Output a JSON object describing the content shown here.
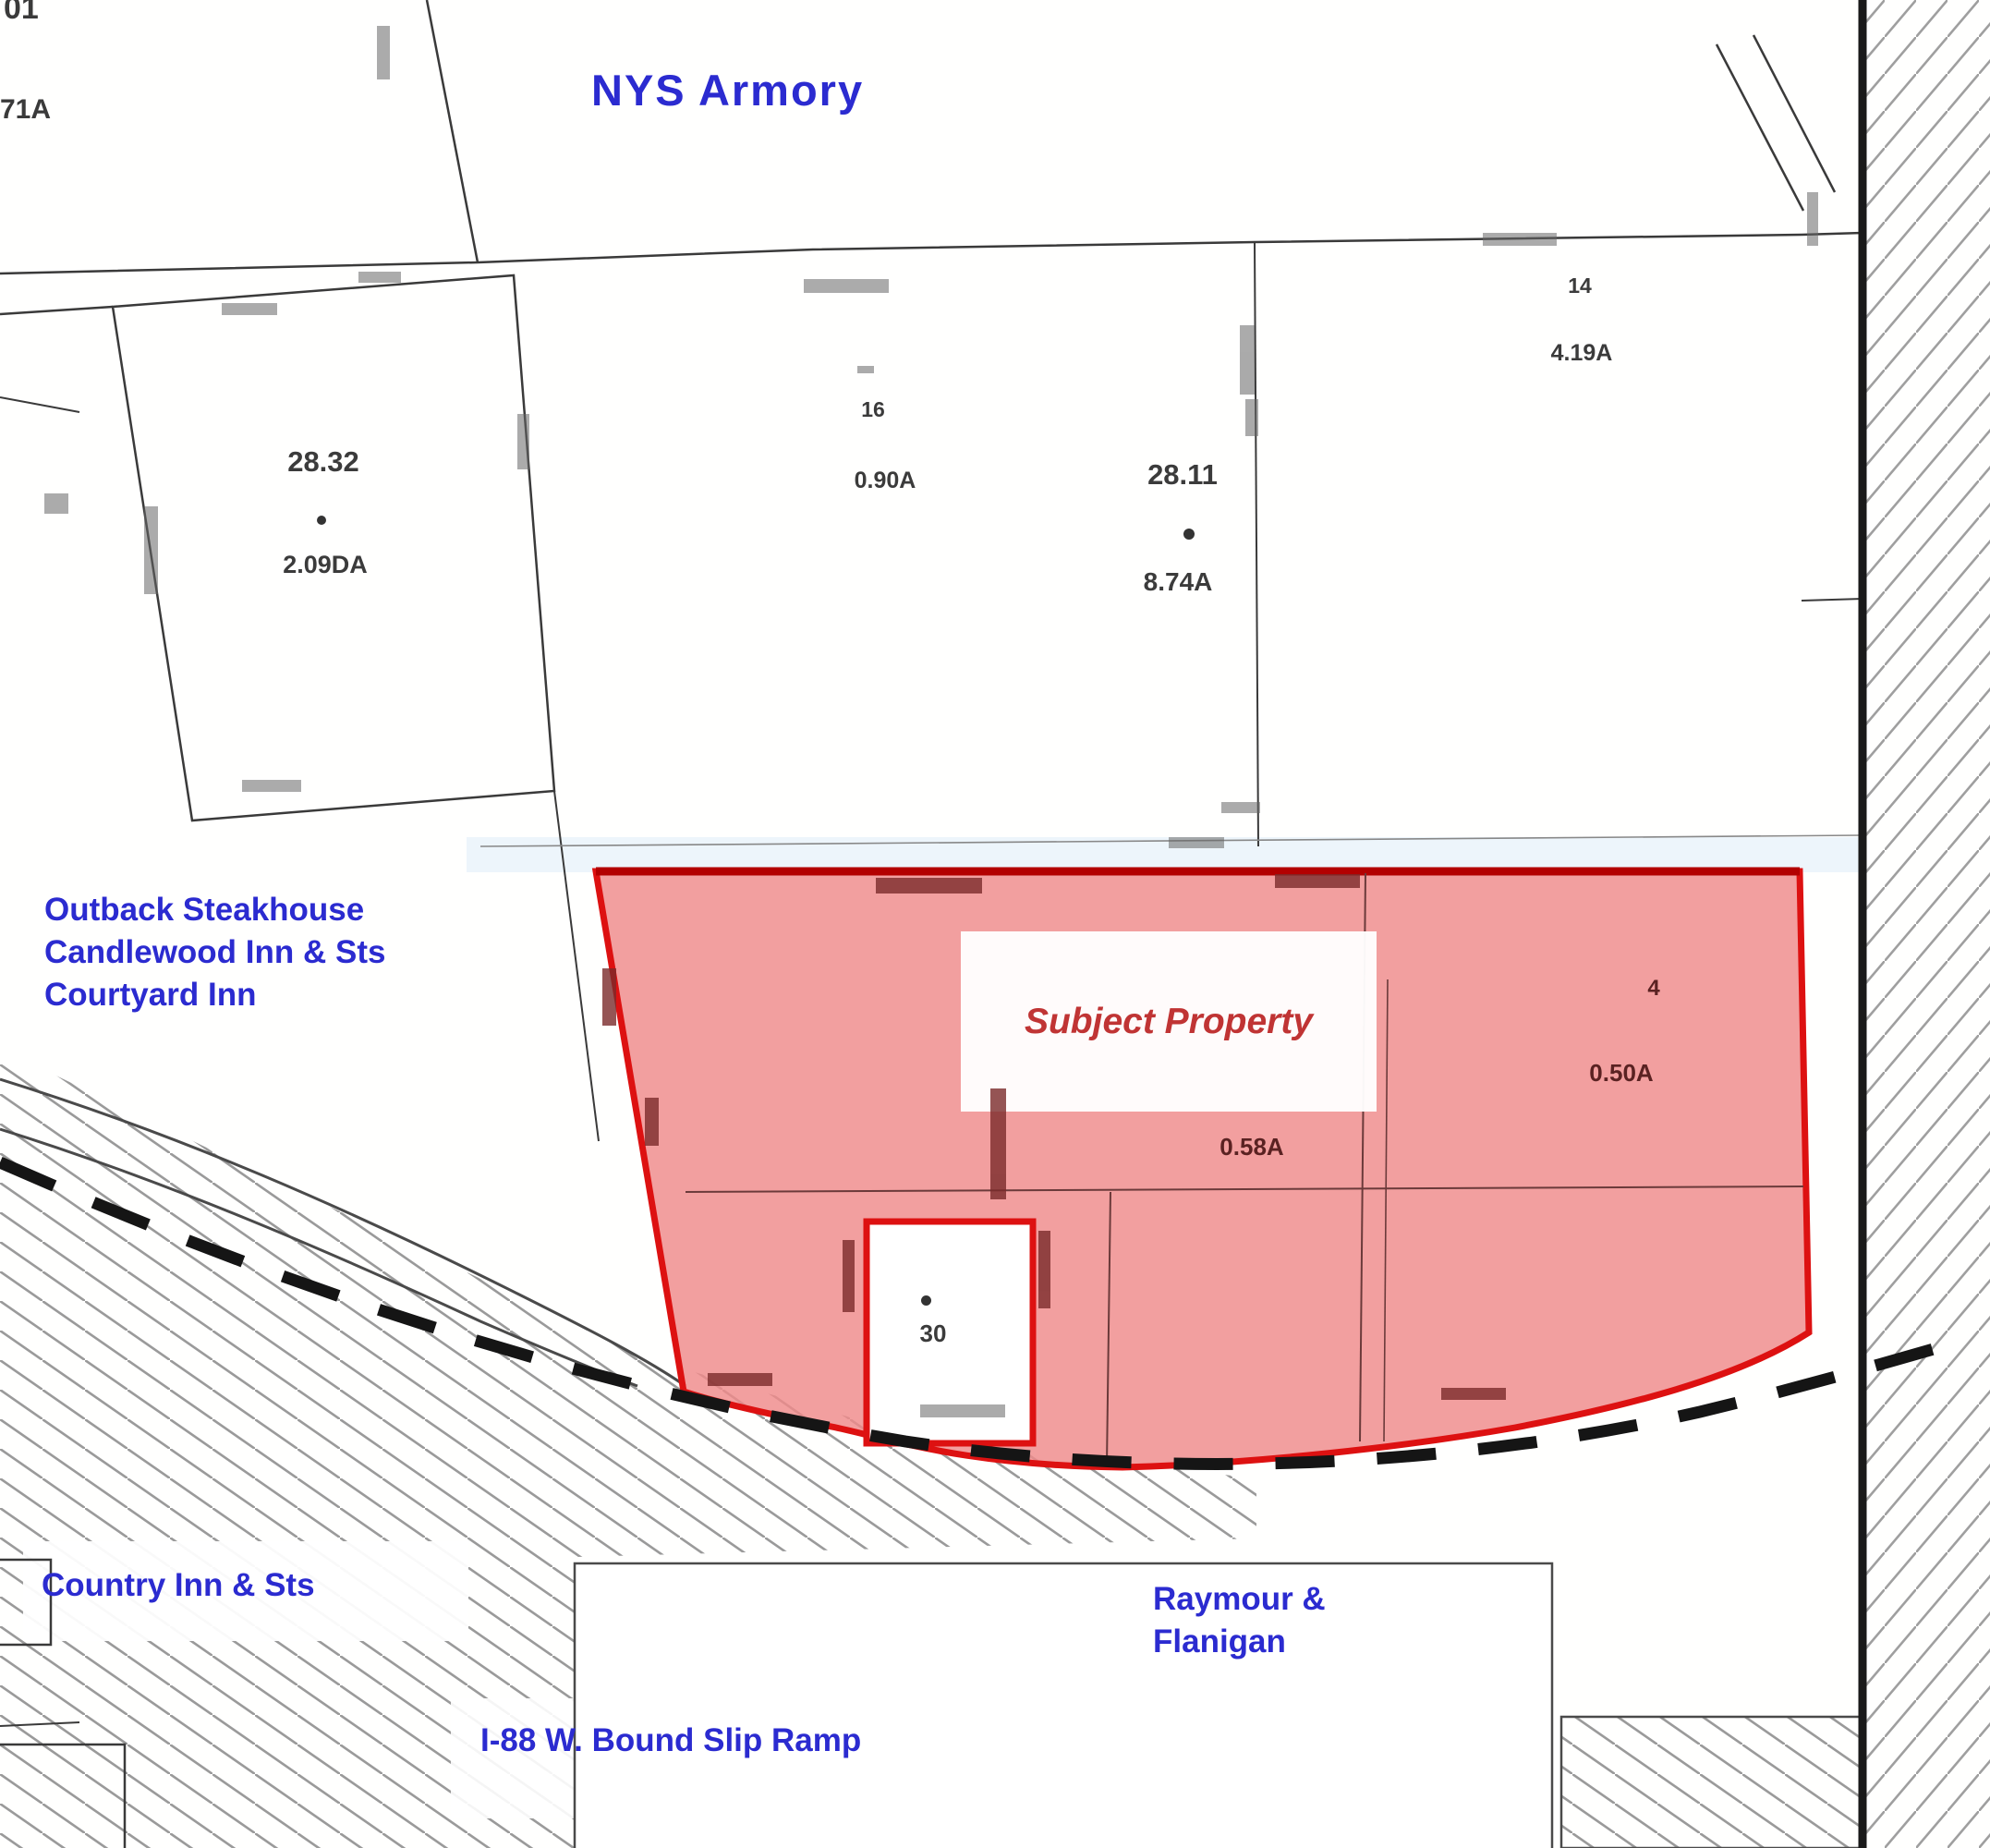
{
  "map": {
    "region_title": "NYS Armory",
    "subject_label": "Subject Property",
    "landmarks": {
      "west_group": "Outback Steakhouse\nCandlewood Inn & Sts\nCourtyard Inn",
      "southwest": "Country Inn & Sts",
      "southeast": "Raymour &\nFlanigan",
      "south_road": "I-88 W. Bound Slip Ramp"
    },
    "parcels": {
      "p28_32": {
        "number": "28.32",
        "area": "2.09DA"
      },
      "p16": {
        "number": "16",
        "area": "0.90A"
      },
      "p28_11": {
        "number": "28.11",
        "area": "8.74A"
      },
      "p14": {
        "number": "14",
        "area": "4.19A"
      },
      "sub_a": {
        "area": "0.58A"
      },
      "sub_b": {
        "area": "0.50A"
      },
      "lot4": {
        "number": "4"
      },
      "notch": {
        "number": "30"
      }
    },
    "edge_fragments": {
      "top_left_upper": "01",
      "top_left_lower": "71A"
    },
    "colors": {
      "label_blue": "#2b2bd0",
      "subject_red": "#c03434",
      "highlight_fill": "#ef8a8a",
      "highlight_border": "#dd1111"
    }
  }
}
